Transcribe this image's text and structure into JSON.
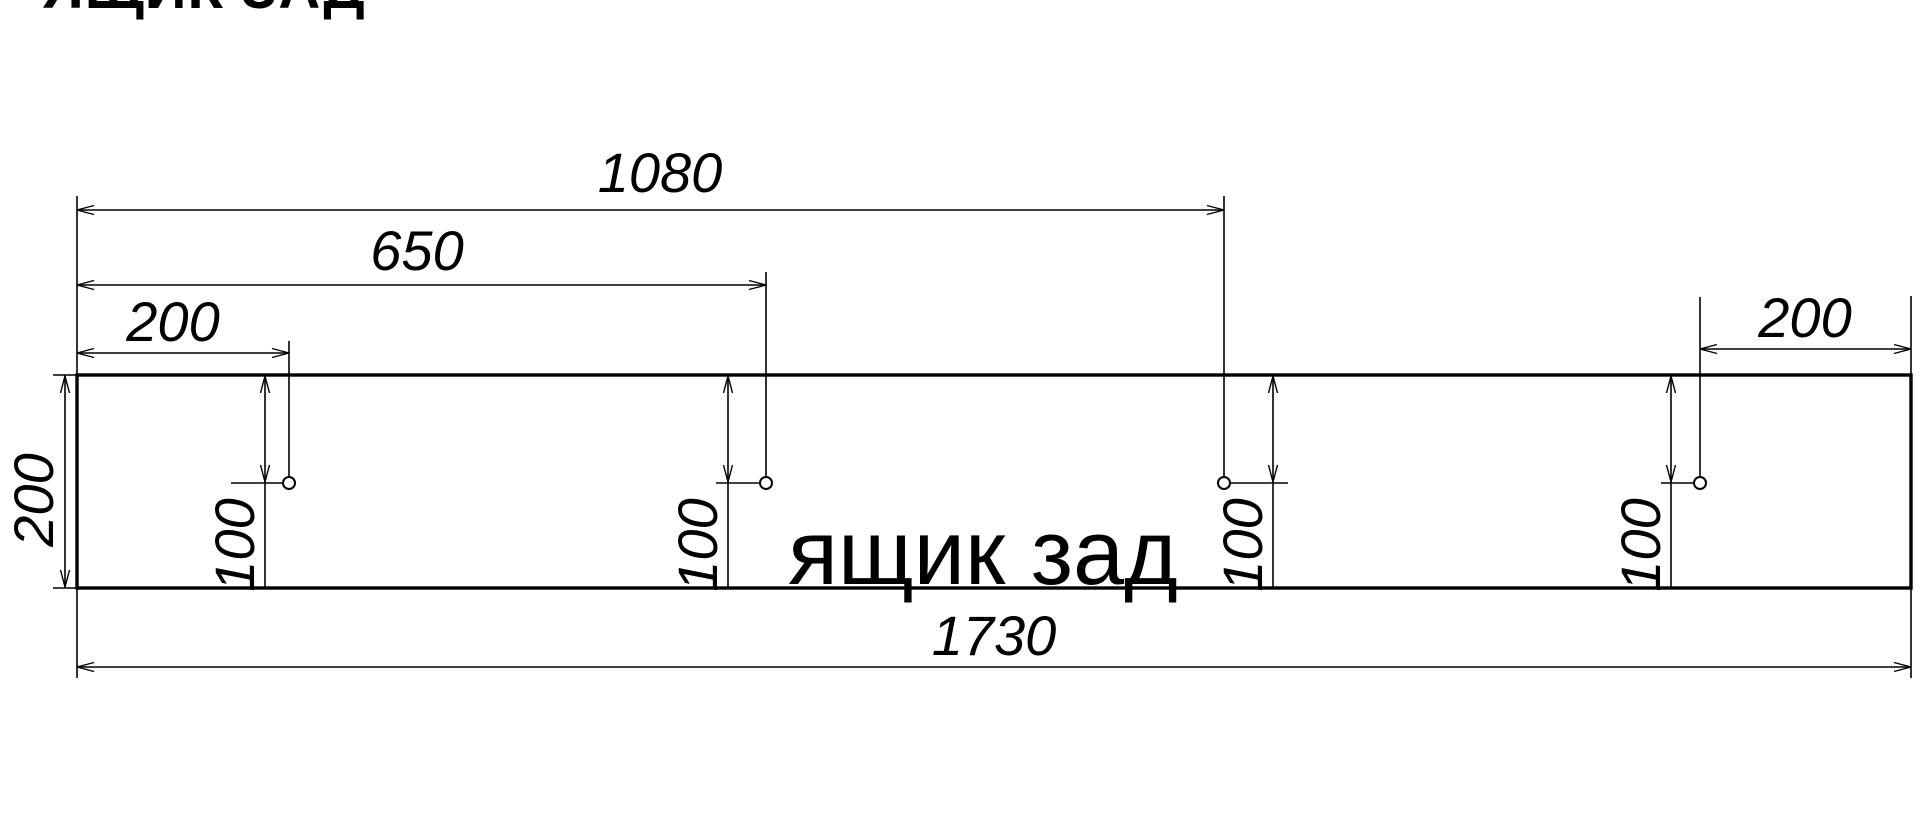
{
  "title": {
    "text": "ЯЩИК ЗАД"
  },
  "part_label": {
    "text": "ящик зад",
    "x": 983,
    "y": 584
  },
  "colors": {
    "line": "#000000",
    "background": "#ffffff"
  },
  "panel": {
    "width_mm": "1730",
    "height_mm": "200",
    "hole_offsets_from_left_mm": [
      "200",
      "650",
      "1080"
    ],
    "hole_offset_from_right_mm": "200",
    "hole_offset_from_top_mm": "100"
  },
  "drawing": {
    "rect": {
      "x": 77,
      "y": 375,
      "w": 1834,
      "h": 213
    },
    "holes": [
      {
        "name": "hole-1",
        "cx": 289,
        "cy": 483,
        "r": 6
      },
      {
        "name": "hole-2",
        "cx": 766,
        "cy": 483,
        "r": 6
      },
      {
        "name": "hole-3",
        "cx": 1224,
        "cy": 483,
        "r": 6
      },
      {
        "name": "hole-4",
        "cx": 1700,
        "cy": 483,
        "r": 6
      }
    ],
    "dimensions": [
      {
        "name": "1080",
        "label": "1080",
        "line": [
          77,
          210,
          1224,
          210
        ],
        "label_pos": {
          "x": 660,
          "y": 192,
          "rotated": false
        },
        "arrows": [
          {
            "x": 77,
            "y": 210,
            "dir": "left"
          },
          {
            "x": 1224,
            "y": 210,
            "dir": "right"
          }
        ],
        "extensions": [
          [
            77,
            196,
            77,
            375
          ],
          [
            1224,
            196,
            1224,
            476
          ]
        ]
      },
      {
        "name": "650",
        "label": "650",
        "line": [
          77,
          285,
          766,
          285
        ],
        "label_pos": {
          "x": 417,
          "y": 270,
          "rotated": false
        },
        "arrows": [
          {
            "x": 77,
            "y": 285,
            "dir": "left"
          },
          {
            "x": 766,
            "y": 285,
            "dir": "right"
          }
        ],
        "extensions": [
          [
            766,
            272,
            766,
            476
          ]
        ]
      },
      {
        "name": "200-top-left",
        "label": "200",
        "line": [
          77,
          353,
          289,
          353
        ],
        "label_pos": {
          "x": 173,
          "y": 341,
          "rotated": false
        },
        "arrows": [
          {
            "x": 77,
            "y": 353,
            "dir": "left"
          },
          {
            "x": 289,
            "y": 353,
            "dir": "right"
          }
        ],
        "extensions": [
          [
            289,
            341,
            289,
            476
          ]
        ]
      },
      {
        "name": "200-top-right",
        "label": "200",
        "line": [
          1700,
          349,
          1911,
          349
        ],
        "label_pos": {
          "x": 1805,
          "y": 337,
          "rotated": false
        },
        "arrows": [
          {
            "x": 1700,
            "y": 349,
            "dir": "left"
          },
          {
            "x": 1911,
            "y": 349,
            "dir": "right"
          }
        ],
        "extensions": [
          [
            1700,
            297,
            1700,
            476
          ],
          [
            1911,
            296,
            1911,
            374
          ]
        ]
      },
      {
        "name": "200-left-height",
        "label": "200",
        "line": [
          65,
          375,
          65,
          588
        ],
        "label_pos": {
          "x": 53,
          "y": 500,
          "rotated": true
        },
        "arrows": [
          {
            "x": 65,
            "y": 376,
            "dir": "up"
          },
          {
            "x": 65,
            "y": 587,
            "dir": "down"
          }
        ],
        "extensions": [
          [
            53,
            375,
            77,
            375
          ],
          [
            53,
            588,
            77,
            588
          ]
        ]
      },
      {
        "name": "1730",
        "label": "1730",
        "line": [
          77,
          667,
          1911,
          667
        ],
        "label_pos": {
          "x": 994,
          "y": 655,
          "rotated": false
        },
        "arrows": [
          {
            "x": 77,
            "y": 667,
            "dir": "left"
          },
          {
            "x": 1911,
            "y": 667,
            "dir": "right"
          }
        ],
        "extensions": [
          [
            77,
            589,
            77,
            678
          ],
          [
            1911,
            589,
            1911,
            678
          ]
        ]
      },
      {
        "name": "100-hole-1",
        "label": "100",
        "line": [
          265,
          375,
          265,
          588
        ],
        "label_pos": {
          "x": 254,
          "y": 545,
          "rotated": true
        },
        "arrows": [
          {
            "x": 265,
            "y": 376,
            "dir": "up"
          },
          {
            "x": 265,
            "y": 482,
            "dir": "down"
          }
        ],
        "extensions": [],
        "tick": [
          231,
          483,
          283,
          483
        ]
      },
      {
        "name": "100-hole-2",
        "label": "100",
        "line": [
          728,
          375,
          728,
          588
        ],
        "label_pos": {
          "x": 717,
          "y": 545,
          "rotated": true
        },
        "arrows": [
          {
            "x": 728,
            "y": 376,
            "dir": "up"
          },
          {
            "x": 728,
            "y": 482,
            "dir": "down"
          }
        ],
        "extensions": [],
        "tick": [
          716,
          483,
          760,
          483
        ]
      },
      {
        "name": "100-hole-3",
        "label": "100",
        "line": [
          1273,
          375,
          1273,
          588
        ],
        "label_pos": {
          "x": 1262,
          "y": 545,
          "rotated": true
        },
        "arrows": [
          {
            "x": 1273,
            "y": 376,
            "dir": "up"
          },
          {
            "x": 1273,
            "y": 482,
            "dir": "down"
          }
        ],
        "extensions": [],
        "tick": [
          1230,
          483,
          1288,
          483
        ]
      },
      {
        "name": "100-hole-4",
        "label": "100",
        "line": [
          1671,
          375,
          1671,
          588
        ],
        "label_pos": {
          "x": 1660,
          "y": 545,
          "rotated": true
        },
        "arrows": [
          {
            "x": 1671,
            "y": 376,
            "dir": "up"
          },
          {
            "x": 1671,
            "y": 482,
            "dir": "down"
          }
        ],
        "extensions": [],
        "tick": [
          1661,
          483,
          1694,
          483
        ]
      }
    ]
  }
}
